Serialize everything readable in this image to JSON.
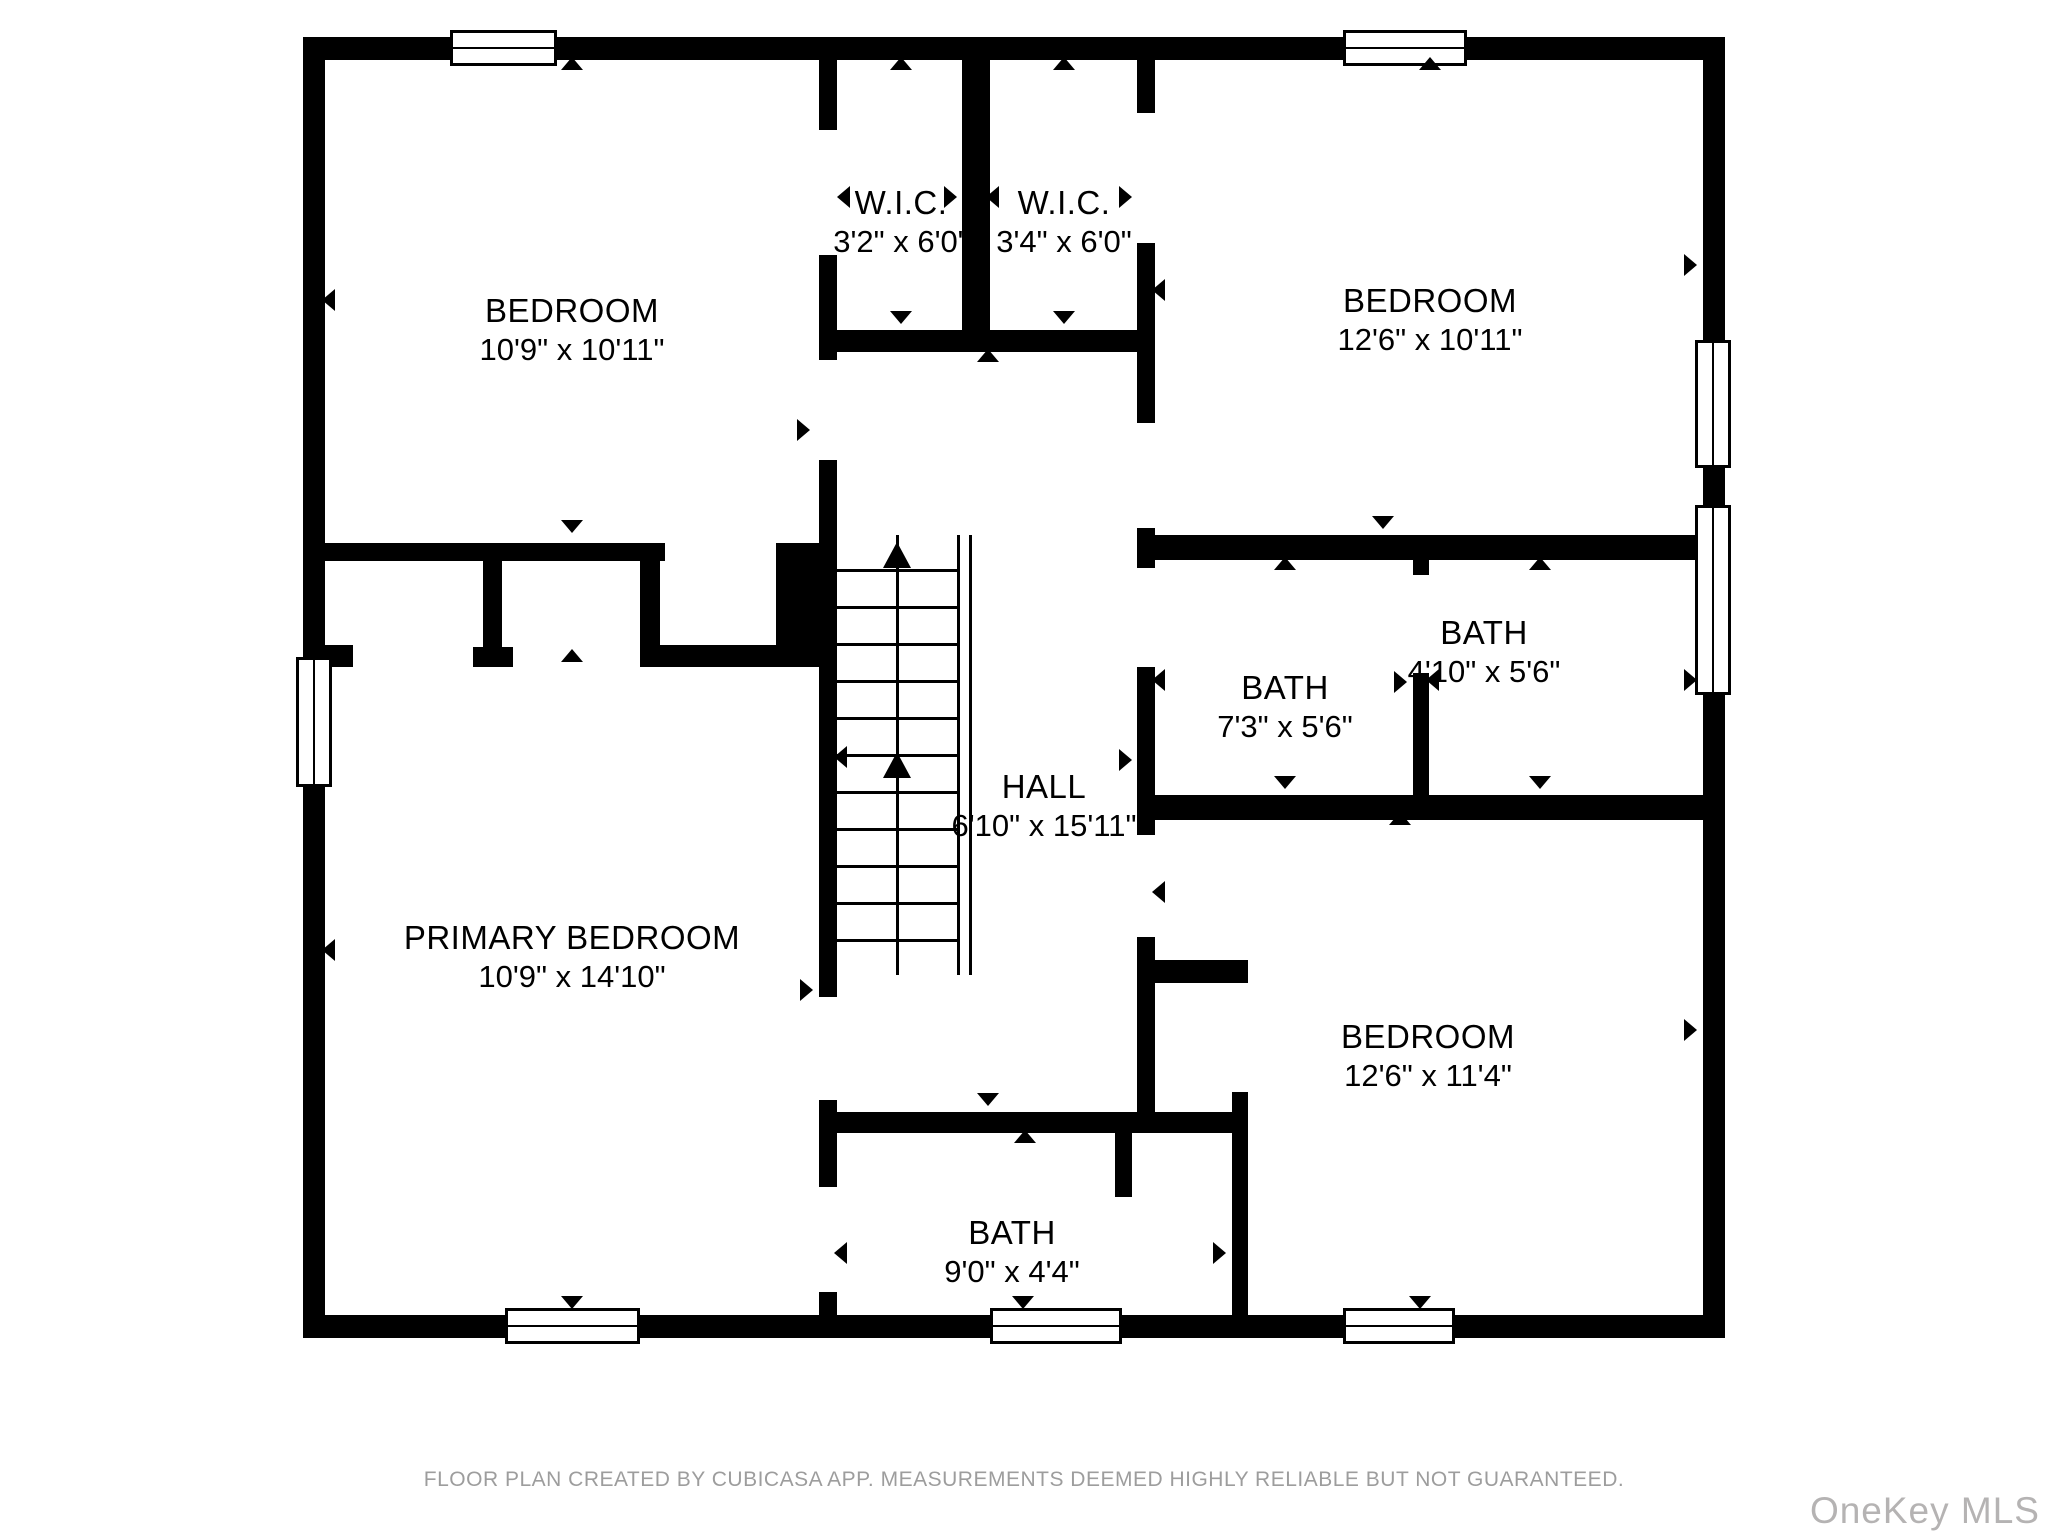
{
  "plan": {
    "rooms": [
      {
        "id": "bedroom-top-left",
        "name": "BEDROOM",
        "dims": "10'9\" x 10'11\""
      },
      {
        "id": "wic-left",
        "name": "W.I.C.",
        "dims": "3'2\" x 6'0\""
      },
      {
        "id": "wic-right",
        "name": "W.I.C.",
        "dims": "3'4\" x 6'0\""
      },
      {
        "id": "bedroom-top-right",
        "name": "BEDROOM",
        "dims": "12'6\" x 10'11\""
      },
      {
        "id": "hall",
        "name": "HALL",
        "dims": "6'10\" x 15'11\""
      },
      {
        "id": "bath-middle",
        "name": "BATH",
        "dims": "7'3\" x 5'6\""
      },
      {
        "id": "bath-right",
        "name": "BATH",
        "dims": "4'10\" x 5'6\""
      },
      {
        "id": "primary-bedroom",
        "name": "PRIMARY BEDROOM",
        "dims": "10'9\" x 14'10\""
      },
      {
        "id": "bath-bottom",
        "name": "BATH",
        "dims": "9'0\" x 4'4\""
      },
      {
        "id": "bedroom-bottom-right",
        "name": "BEDROOM",
        "dims": "12'6\" x 11'4\""
      }
    ]
  },
  "footer": {
    "disclaimer": "FLOOR PLAN CREATED BY CUBICASA APP. MEASUREMENTS DEEMED HIGHLY RELIABLE BUT NOT GUARANTEED.",
    "watermark": "OneKey MLS"
  },
  "colors": {
    "wall": "#000000",
    "floor": "#ffffff",
    "label_text": "#000000",
    "disclaimer_text": "#9d9d9d",
    "watermark_text": "#b5b3b3"
  }
}
